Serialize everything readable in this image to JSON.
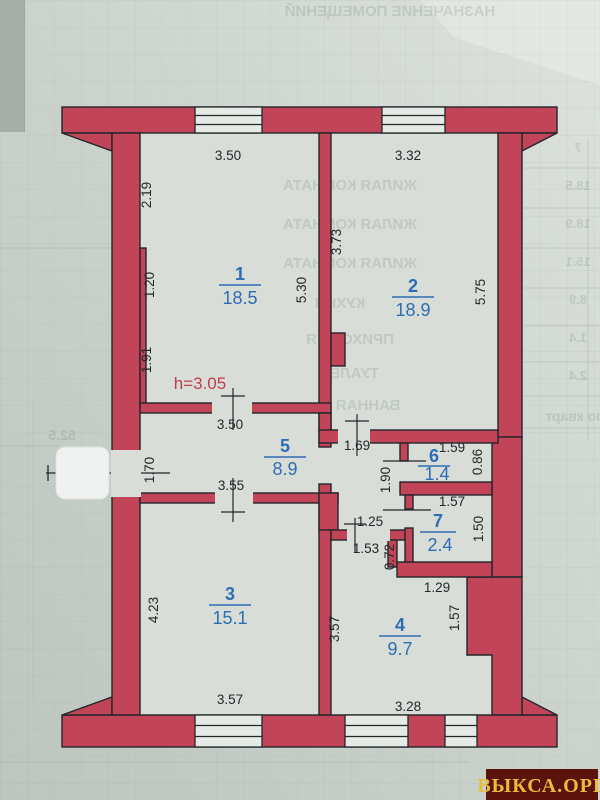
{
  "plan": {
    "height_note": "h=3.05",
    "rooms": [
      {
        "number": "1",
        "area": "18.5"
      },
      {
        "number": "2",
        "area": "18.9"
      },
      {
        "number": "3",
        "area": "15.1"
      },
      {
        "number": "4",
        "area": "9.7"
      },
      {
        "number": "5",
        "area": "8.9"
      },
      {
        "number": "6",
        "area": "1.4"
      },
      {
        "number": "7",
        "area": "2.4"
      }
    ],
    "dims": {
      "r1_top": "3.50",
      "r2_top": "3.32",
      "r1_left_upper": "2.19",
      "r1_left_lower": "1.20",
      "hall_left": "1.91",
      "r1_right": "5.30",
      "r2_left": "3.73",
      "r2_right": "5.75",
      "hall_top": "3.50",
      "hall_bottom": "3.55",
      "entrance": "1.70",
      "corr_top": "1.69",
      "r6_top": "1.59",
      "r6_right": "0.86",
      "corr_len": "1.90",
      "r7_top": "1.57",
      "r7_right": "1.50",
      "corr_low": "1.25",
      "corr_door": "1.53",
      "stub": "0.72",
      "r4_step": "1.29",
      "r3_left": "4.23",
      "r3_bottom": "3.57",
      "r4_left": "3.57",
      "r4_right": "1.57",
      "r4_bottom": "3.28"
    },
    "colors": {
      "wall": "#c24459",
      "room_label": "#2e6cb5",
      "dimension": "#23262b",
      "height_note": "#c43b50",
      "paper_room": "#d8ded7"
    }
  },
  "watermark": {
    "text": "ВЫКСА.ОРГ",
    "bg": "#5d130d",
    "fg": "#e9bc3e"
  },
  "ghost": {
    "title": "НАЗНАЧЕНИЕ ПОМЕЩЕНИЙ",
    "rows": [
      "ЖИЛАЯ КОМНАТА",
      "ЖИЛАЯ КОМНАТА",
      "ЖИЛАЯ КОМНАТА",
      "КУХНЯ",
      "ПРИХОЖАЯ",
      "ТУАЛЕТ",
      "ВАННАЯ"
    ],
    "numbers": [
      "7",
      "18.5",
      "18.9",
      "15.1",
      "8.9",
      "1.4",
      "2.4"
    ],
    "total": "52.5",
    "corner": "по кварт"
  }
}
